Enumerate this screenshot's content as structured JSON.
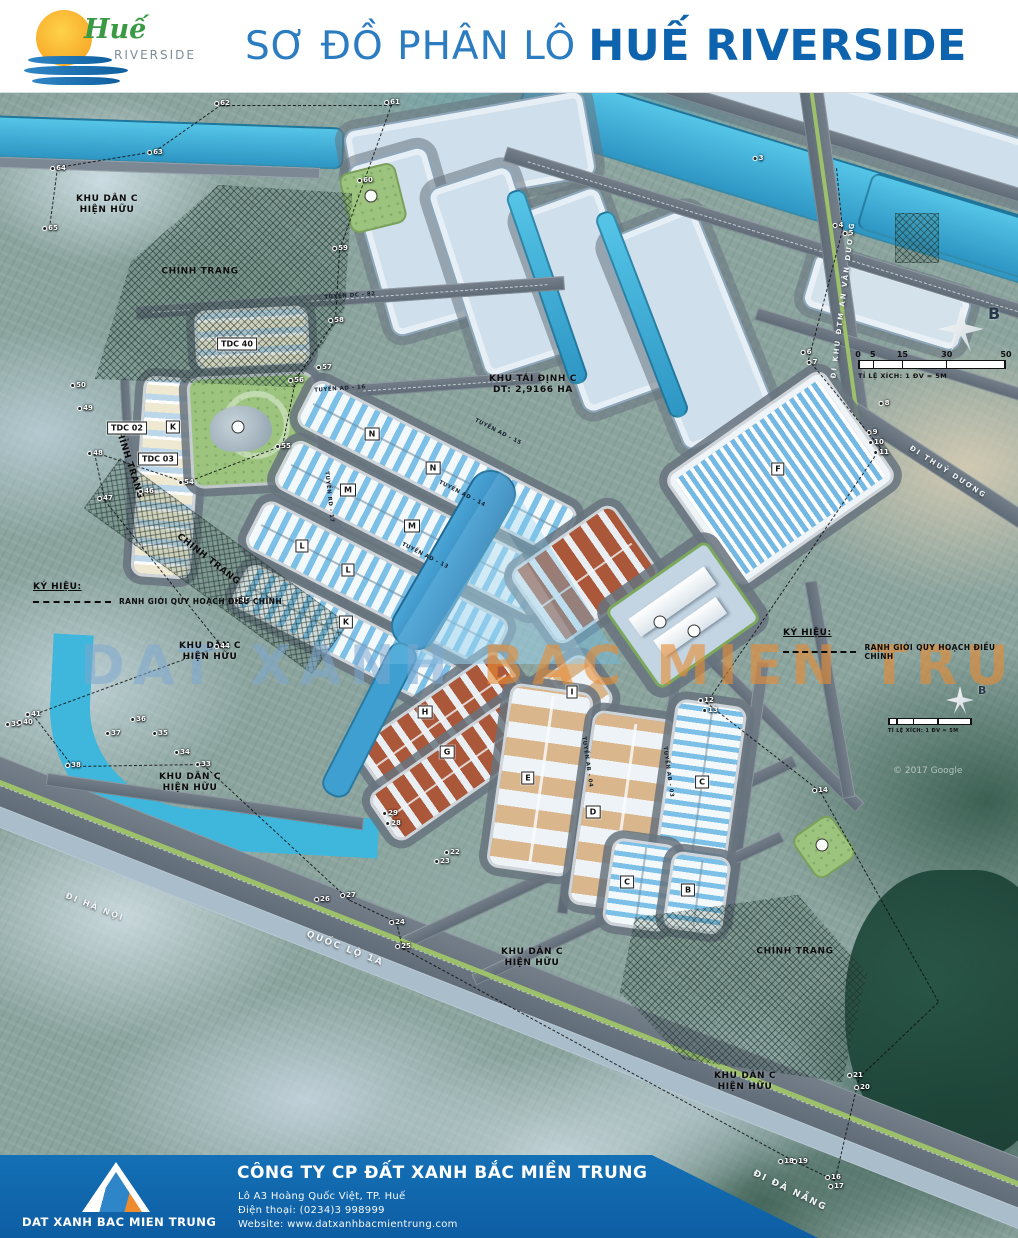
{
  "header": {
    "title_regular": "SƠ ĐỒ PHÂN LÔ",
    "title_bold": "HUẾ RIVERSIDE",
    "logo": {
      "script": "Huế",
      "sub": "RIVERSIDE"
    }
  },
  "footer": {
    "company": "CÔNG TY CP ĐẤT XANH BẮC MIỀN TRUNG",
    "address": "Lô A3 Hoàng Quốc Việt, TP. Huế",
    "phone": "Điện thoại: (0234)3 998999",
    "website": "Website:  www.datxanhbacmientrung.com",
    "logo_text": "DAT XANH BAC MIEN TRUNG"
  },
  "map": {
    "watermark": {
      "part1": "DAT XANH ",
      "part2": "BAC MIEN TRUNG"
    },
    "credit": "© 2017 Google",
    "legend": {
      "title": "KÝ HIỆU:",
      "item": "RANH GIỚI QUY HOẠCH ĐIỀU CHỈNH"
    },
    "scalebar": {
      "ticks": [
        "0",
        "5",
        "15",
        "30",
        "50"
      ],
      "caption": "TỈ LỆ XÍCH: 1 ĐV = 5M",
      "north": "B"
    },
    "area_labels": [
      {
        "t": "KHU DÂN C\nHIỆN HỮU",
        "x": 107,
        "y": 205
      },
      {
        "t": "CHỈNH TRANG",
        "x": 200,
        "y": 272
      },
      {
        "t": "KHU DÂN C\nHIỆN HỮU",
        "x": 210,
        "y": 652
      },
      {
        "t": "KHU DÂN C\nHIỆN HỮU",
        "x": 190,
        "y": 783
      },
      {
        "t": "KHU DÂN C\nHIỆN HỮU",
        "x": 532,
        "y": 958
      },
      {
        "t": "KHU DÂN C\nHIỆN HỮU",
        "x": 745,
        "y": 1082
      },
      {
        "t": "CHỈNH TRANG",
        "x": 795,
        "y": 952
      },
      {
        "t": "CHỈNH TRANG",
        "x": 128,
        "y": 462,
        "rot": 72
      },
      {
        "t": "CHỈNH TRANG",
        "x": 208,
        "y": 560,
        "rot": 38
      },
      {
        "t": "KHU TÁI ĐỊNH C\nDT: 2,9166 HA",
        "x": 533,
        "y": 385
      }
    ],
    "road_labels": [
      {
        "t": "ĐI HÀ NỘI",
        "x": 95,
        "y": 907,
        "rot": 22,
        "fs": 8
      },
      {
        "t": "QUỐC LỘ 1A",
        "x": 345,
        "y": 949,
        "rot": 21,
        "fs": 9
      },
      {
        "t": "ĐI ĐÀ NẴNG",
        "x": 790,
        "y": 1191,
        "rot": 26,
        "fs": 9
      },
      {
        "t": "ĐI KHU ĐTM AN VÂN DƯƠNG",
        "x": 843,
        "y": 300,
        "rot": -83,
        "fs": 7
      },
      {
        "t": "ĐI THUỶ DƯƠNG",
        "x": 948,
        "y": 472,
        "rot": 33,
        "fs": 7
      }
    ],
    "street_labels": [
      {
        "t": "TUYẾN DC - 82",
        "x": 350,
        "y": 296,
        "rot": -4
      },
      {
        "t": "TUYẾN AD - 16",
        "x": 340,
        "y": 389,
        "rot": -4
      },
      {
        "t": "TUYẾN RD - 17",
        "x": 329,
        "y": 497,
        "rot": 84
      },
      {
        "t": "TUYẾN AD - 15",
        "x": 498,
        "y": 432,
        "rot": 27
      },
      {
        "t": "TUYẾN AD - 14",
        "x": 462,
        "y": 494,
        "rot": 27
      },
      {
        "t": "TUYẾN AD - 13",
        "x": 425,
        "y": 556,
        "rot": 27
      },
      {
        "t": "TUYẾN AB - 04",
        "x": 587,
        "y": 762,
        "rot": 82
      },
      {
        "t": "TUYẾN AB - 03",
        "x": 668,
        "y": 772,
        "rot": 82
      }
    ],
    "block_chips": [
      {
        "t": "K",
        "x": 173,
        "y": 427
      },
      {
        "t": "TDC 02",
        "x": 127,
        "y": 428
      },
      {
        "t": "TDC 03",
        "x": 158,
        "y": 459
      },
      {
        "t": "TDC 40",
        "x": 237,
        "y": 344
      },
      {
        "t": "K",
        "x": 346,
        "y": 622
      },
      {
        "t": "N",
        "x": 372,
        "y": 434
      },
      {
        "t": "N",
        "x": 433,
        "y": 468
      },
      {
        "t": "M",
        "x": 348,
        "y": 490
      },
      {
        "t": "M",
        "x": 412,
        "y": 526
      },
      {
        "t": "L",
        "x": 302,
        "y": 546
      },
      {
        "t": "L",
        "x": 348,
        "y": 570
      },
      {
        "t": "F",
        "x": 778,
        "y": 469
      },
      {
        "t": "I",
        "x": 572,
        "y": 692
      },
      {
        "t": "H",
        "x": 425,
        "y": 712
      },
      {
        "t": "G",
        "x": 447,
        "y": 752
      },
      {
        "t": "E",
        "x": 528,
        "y": 778
      },
      {
        "t": "D",
        "x": 593,
        "y": 812
      },
      {
        "t": "C",
        "x": 702,
        "y": 782
      },
      {
        "t": "C",
        "x": 627,
        "y": 882
      },
      {
        "t": "B",
        "x": 688,
        "y": 890
      }
    ],
    "boundary_points": [
      {
        "n": "3",
        "x": 758,
        "y": 158
      },
      {
        "n": "4",
        "x": 838,
        "y": 225
      },
      {
        "n": "5",
        "x": 848,
        "y": 233
      },
      {
        "n": "6",
        "x": 806,
        "y": 352
      },
      {
        "n": "7",
        "x": 812,
        "y": 362
      },
      {
        "n": "8",
        "x": 884,
        "y": 403
      },
      {
        "n": "9",
        "x": 872,
        "y": 432
      },
      {
        "n": "10",
        "x": 876,
        "y": 442
      },
      {
        "n": "11",
        "x": 881,
        "y": 452
      },
      {
        "n": "12",
        "x": 706,
        "y": 700
      },
      {
        "n": "13",
        "x": 710,
        "y": 710
      },
      {
        "n": "14",
        "x": 820,
        "y": 790
      },
      {
        "n": "16",
        "x": 833,
        "y": 1177
      },
      {
        "n": "17",
        "x": 836,
        "y": 1186
      },
      {
        "n": "18",
        "x": 786,
        "y": 1161
      },
      {
        "n": "19",
        "x": 800,
        "y": 1161
      },
      {
        "n": "20",
        "x": 862,
        "y": 1087
      },
      {
        "n": "21",
        "x": 855,
        "y": 1075
      },
      {
        "n": "22",
        "x": 452,
        "y": 852
      },
      {
        "n": "23",
        "x": 442,
        "y": 861
      },
      {
        "n": "24",
        "x": 397,
        "y": 922
      },
      {
        "n": "25",
        "x": 403,
        "y": 946
      },
      {
        "n": "26",
        "x": 322,
        "y": 899
      },
      {
        "n": "27",
        "x": 348,
        "y": 895
      },
      {
        "n": "28",
        "x": 393,
        "y": 823
      },
      {
        "n": "29",
        "x": 390,
        "y": 813
      },
      {
        "n": "33",
        "x": 203,
        "y": 764
      },
      {
        "n": "34",
        "x": 182,
        "y": 752
      },
      {
        "n": "35",
        "x": 160,
        "y": 733
      },
      {
        "n": "36",
        "x": 138,
        "y": 719
      },
      {
        "n": "37",
        "x": 113,
        "y": 733
      },
      {
        "n": "38",
        "x": 73,
        "y": 765
      },
      {
        "n": "39",
        "x": 13,
        "y": 724
      },
      {
        "n": "40",
        "x": 25,
        "y": 722
      },
      {
        "n": "41",
        "x": 33,
        "y": 714
      },
      {
        "n": "44",
        "x": 222,
        "y": 646
      },
      {
        "n": "45",
        "x": 242,
        "y": 600
      },
      {
        "n": "46",
        "x": 146,
        "y": 491
      },
      {
        "n": "47",
        "x": 105,
        "y": 498
      },
      {
        "n": "48",
        "x": 95,
        "y": 453
      },
      {
        "n": "49",
        "x": 85,
        "y": 408
      },
      {
        "n": "50",
        "x": 78,
        "y": 385
      },
      {
        "n": "54",
        "x": 186,
        "y": 482
      },
      {
        "n": "55",
        "x": 283,
        "y": 446
      },
      {
        "n": "56",
        "x": 296,
        "y": 380
      },
      {
        "n": "57",
        "x": 324,
        "y": 367
      },
      {
        "n": "58",
        "x": 336,
        "y": 320
      },
      {
        "n": "59",
        "x": 340,
        "y": 248
      },
      {
        "n": "60",
        "x": 365,
        "y": 180
      },
      {
        "n": "61",
        "x": 392,
        "y": 102
      },
      {
        "n": "62",
        "x": 222,
        "y": 103
      },
      {
        "n": "63",
        "x": 155,
        "y": 152
      },
      {
        "n": "64",
        "x": 58,
        "y": 168
      },
      {
        "n": "65",
        "x": 50,
        "y": 228
      }
    ]
  }
}
